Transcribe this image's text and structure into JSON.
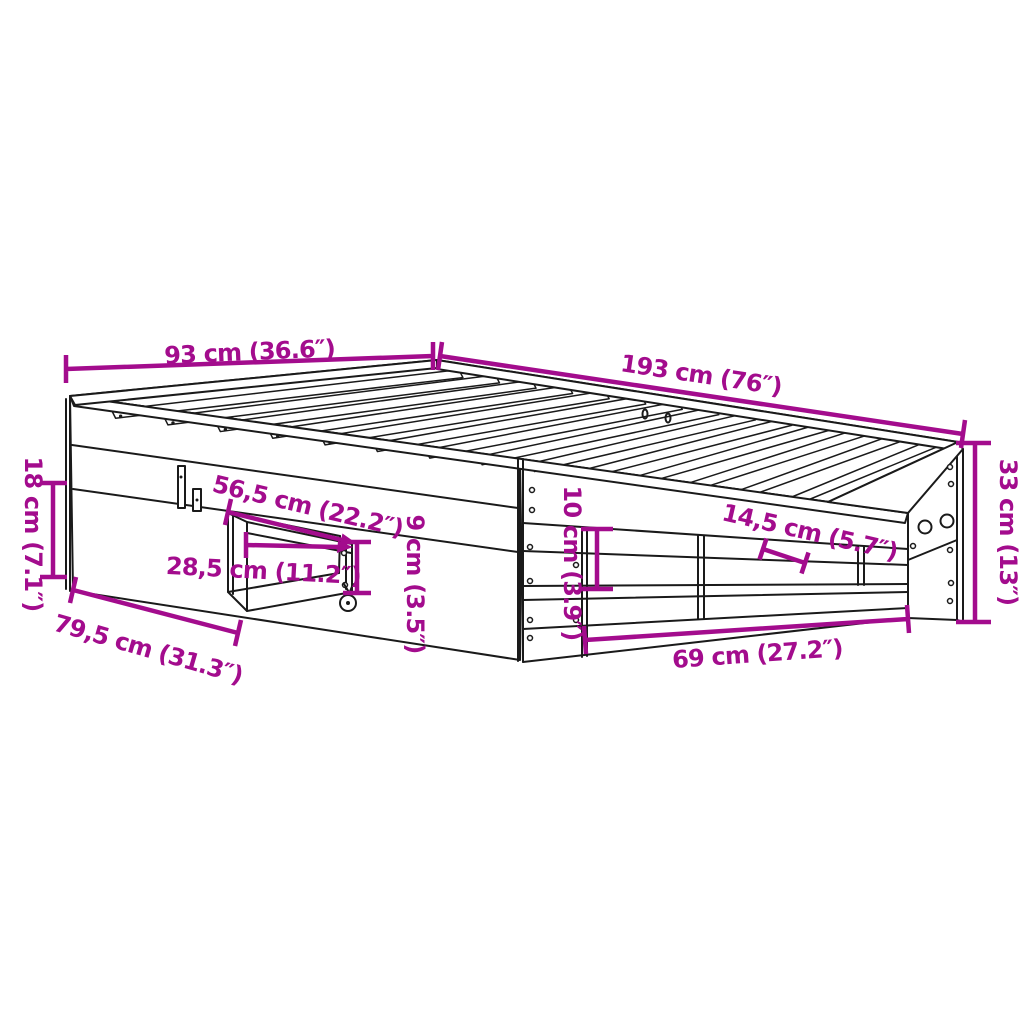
{
  "diagram": {
    "title": "Bed frame dimension diagram",
    "product": "bed frame with pull-out drawer and side shelf",
    "colors": {
      "dimension": "#A30C8D",
      "outline": "#1a1a1a",
      "background": "#ffffff"
    },
    "dims": [
      {
        "name": "bed-width",
        "label": "93 cm (36.6″)"
      },
      {
        "name": "bed-length",
        "label": "193 cm (76″)"
      },
      {
        "name": "frame-height",
        "label": "33 cm (13″)"
      },
      {
        "name": "side-rail-height",
        "label": "18 cm (7.1″)"
      },
      {
        "name": "drawer-extension-bottom",
        "label": "79,5 cm (31.3″)"
      },
      {
        "name": "drawer-extension-top",
        "label": "56,5 cm (22.2″)"
      },
      {
        "name": "drawer-front-width",
        "label": "28,5 cm (11.2″)"
      },
      {
        "name": "drawer-height",
        "label": "9 cm (3.5″)"
      },
      {
        "name": "opening-height",
        "label": "10 cm (3.9″)"
      },
      {
        "name": "shelf-depth",
        "label": "14,5 cm (5.7″)"
      },
      {
        "name": "opening-width",
        "label": "69 cm (27.2″)"
      }
    ]
  }
}
